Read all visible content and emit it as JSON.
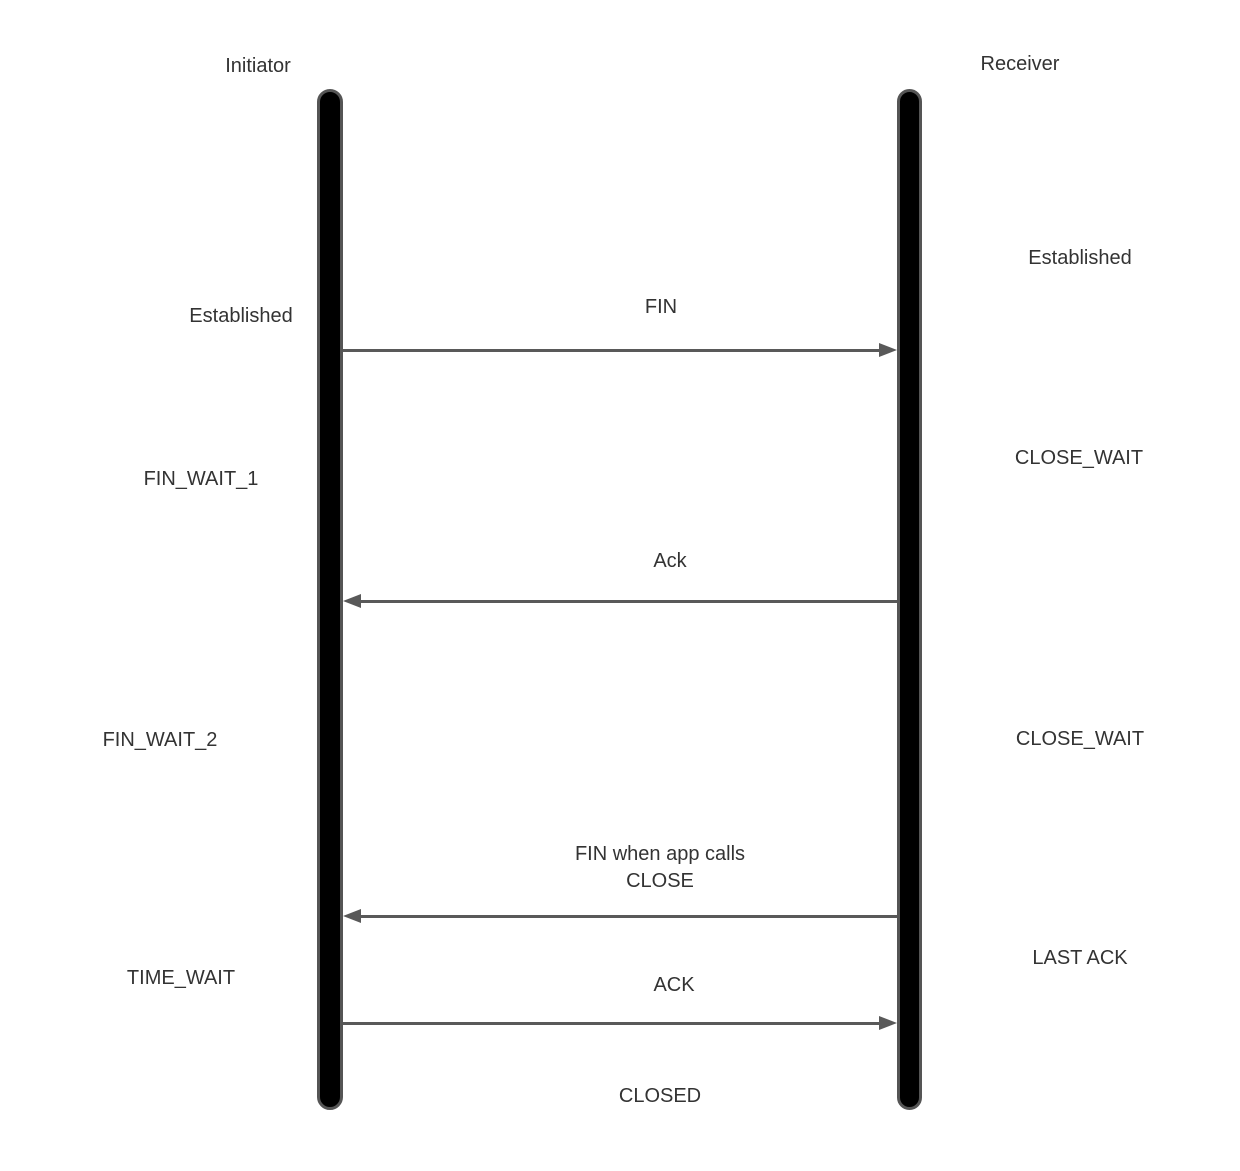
{
  "participants": [
    {
      "name": "Initiator"
    },
    {
      "name": "Receiver"
    }
  ],
  "messages": [
    {
      "label": "FIN",
      "from": "Initiator",
      "to": "Receiver",
      "direction": "right"
    },
    {
      "label": "Ack",
      "from": "Receiver",
      "to": "Initiator",
      "direction": "left"
    },
    {
      "line1": "FIN when app calls",
      "line2": "CLOSE",
      "from": "Receiver",
      "to": "Initiator",
      "direction": "left"
    },
    {
      "label": "ACK",
      "from": "Initiator",
      "to": "Receiver",
      "direction": "right"
    }
  ],
  "states": {
    "initiator": [
      {
        "label": "Established"
      },
      {
        "label": "FIN_WAIT_1"
      },
      {
        "label": "FIN_WAIT_2"
      },
      {
        "label": "TIME_WAIT"
      }
    ],
    "receiver": [
      {
        "label": "Established"
      },
      {
        "label": "CLOSE_WAIT"
      },
      {
        "label": "CLOSE_WAIT"
      },
      {
        "label": "LAST ACK"
      }
    ],
    "final": "CLOSED"
  },
  "colors": {
    "lifeline_fill": "#000000",
    "lifeline_border": "#555555",
    "arrow": "#595959",
    "text": "#333333",
    "background": "#ffffff"
  }
}
